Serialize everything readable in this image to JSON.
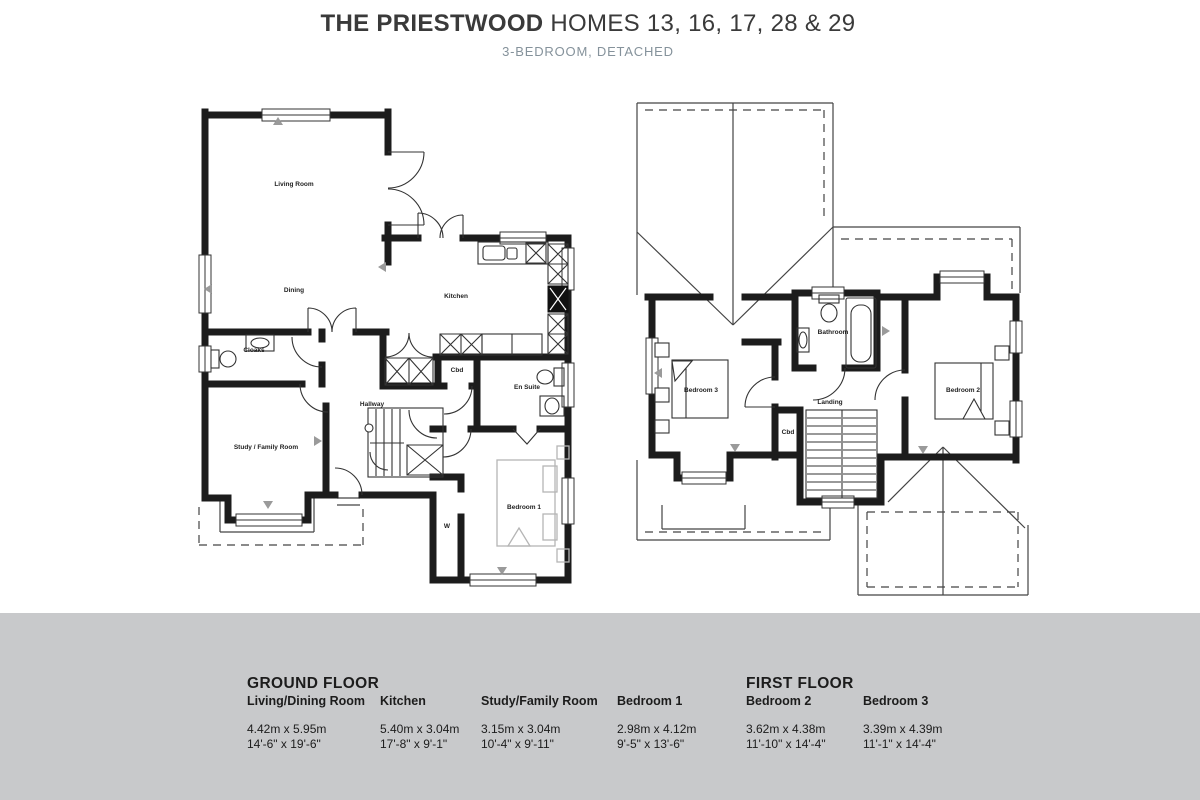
{
  "header": {
    "title_bold": "THE PRIESTWOOD",
    "title_rest": "HOMES 13, 16, 17, 28 & 29",
    "subtitle": "3-BEDROOM, DETACHED"
  },
  "plans": {
    "ground": {
      "living_room": "Living Room",
      "dining": "Dining",
      "kitchen": "Kitchen",
      "cloaks": "Cloaks",
      "study": "Study / Family Room",
      "hallway": "Hallway",
      "cbd_hall": "Cbd",
      "en_suite": "En Suite",
      "bedroom1": "Bedroom 1",
      "wardrobe": "W"
    },
    "first": {
      "bathroom": "Bathroom",
      "landing": "Landing",
      "cbd": "Cbd",
      "bedroom2": "Bedroom 2",
      "bedroom3": "Bedroom 3"
    }
  },
  "spec": {
    "ground": {
      "heading": "GROUND FLOOR",
      "rooms": [
        {
          "name": "Living/Dining Room",
          "metric": "4.42m x 5.95m",
          "imperial": "14'-6\" x 19'-6\""
        },
        {
          "name": "Kitchen",
          "metric": "5.40m x 3.04m",
          "imperial": "17'-8\" x 9'-1\""
        },
        {
          "name": "Study/Family Room",
          "metric": "3.15m x 3.04m",
          "imperial": "10'-4\" x 9'-11\""
        },
        {
          "name": "Bedroom 1",
          "metric": "2.98m x 4.12m",
          "imperial": "9'-5\" x 13'-6\""
        }
      ]
    },
    "first": {
      "heading": "FIRST FLOOR",
      "rooms": [
        {
          "name": "Bedroom 2",
          "metric": "3.62m x 4.38m",
          "imperial": "11'-10\" x 14'-4\""
        },
        {
          "name": "Bedroom 3",
          "metric": "3.39m x 4.39m",
          "imperial": "11'-1\" x 14'-4\""
        }
      ]
    }
  },
  "colors": {
    "wall": "#1c1c1c",
    "footer_band": "#c8c9cb",
    "subtitle": "#85929b",
    "furniture_gray": "#b5b5b5",
    "marker_gray": "#9a9a9a"
  }
}
